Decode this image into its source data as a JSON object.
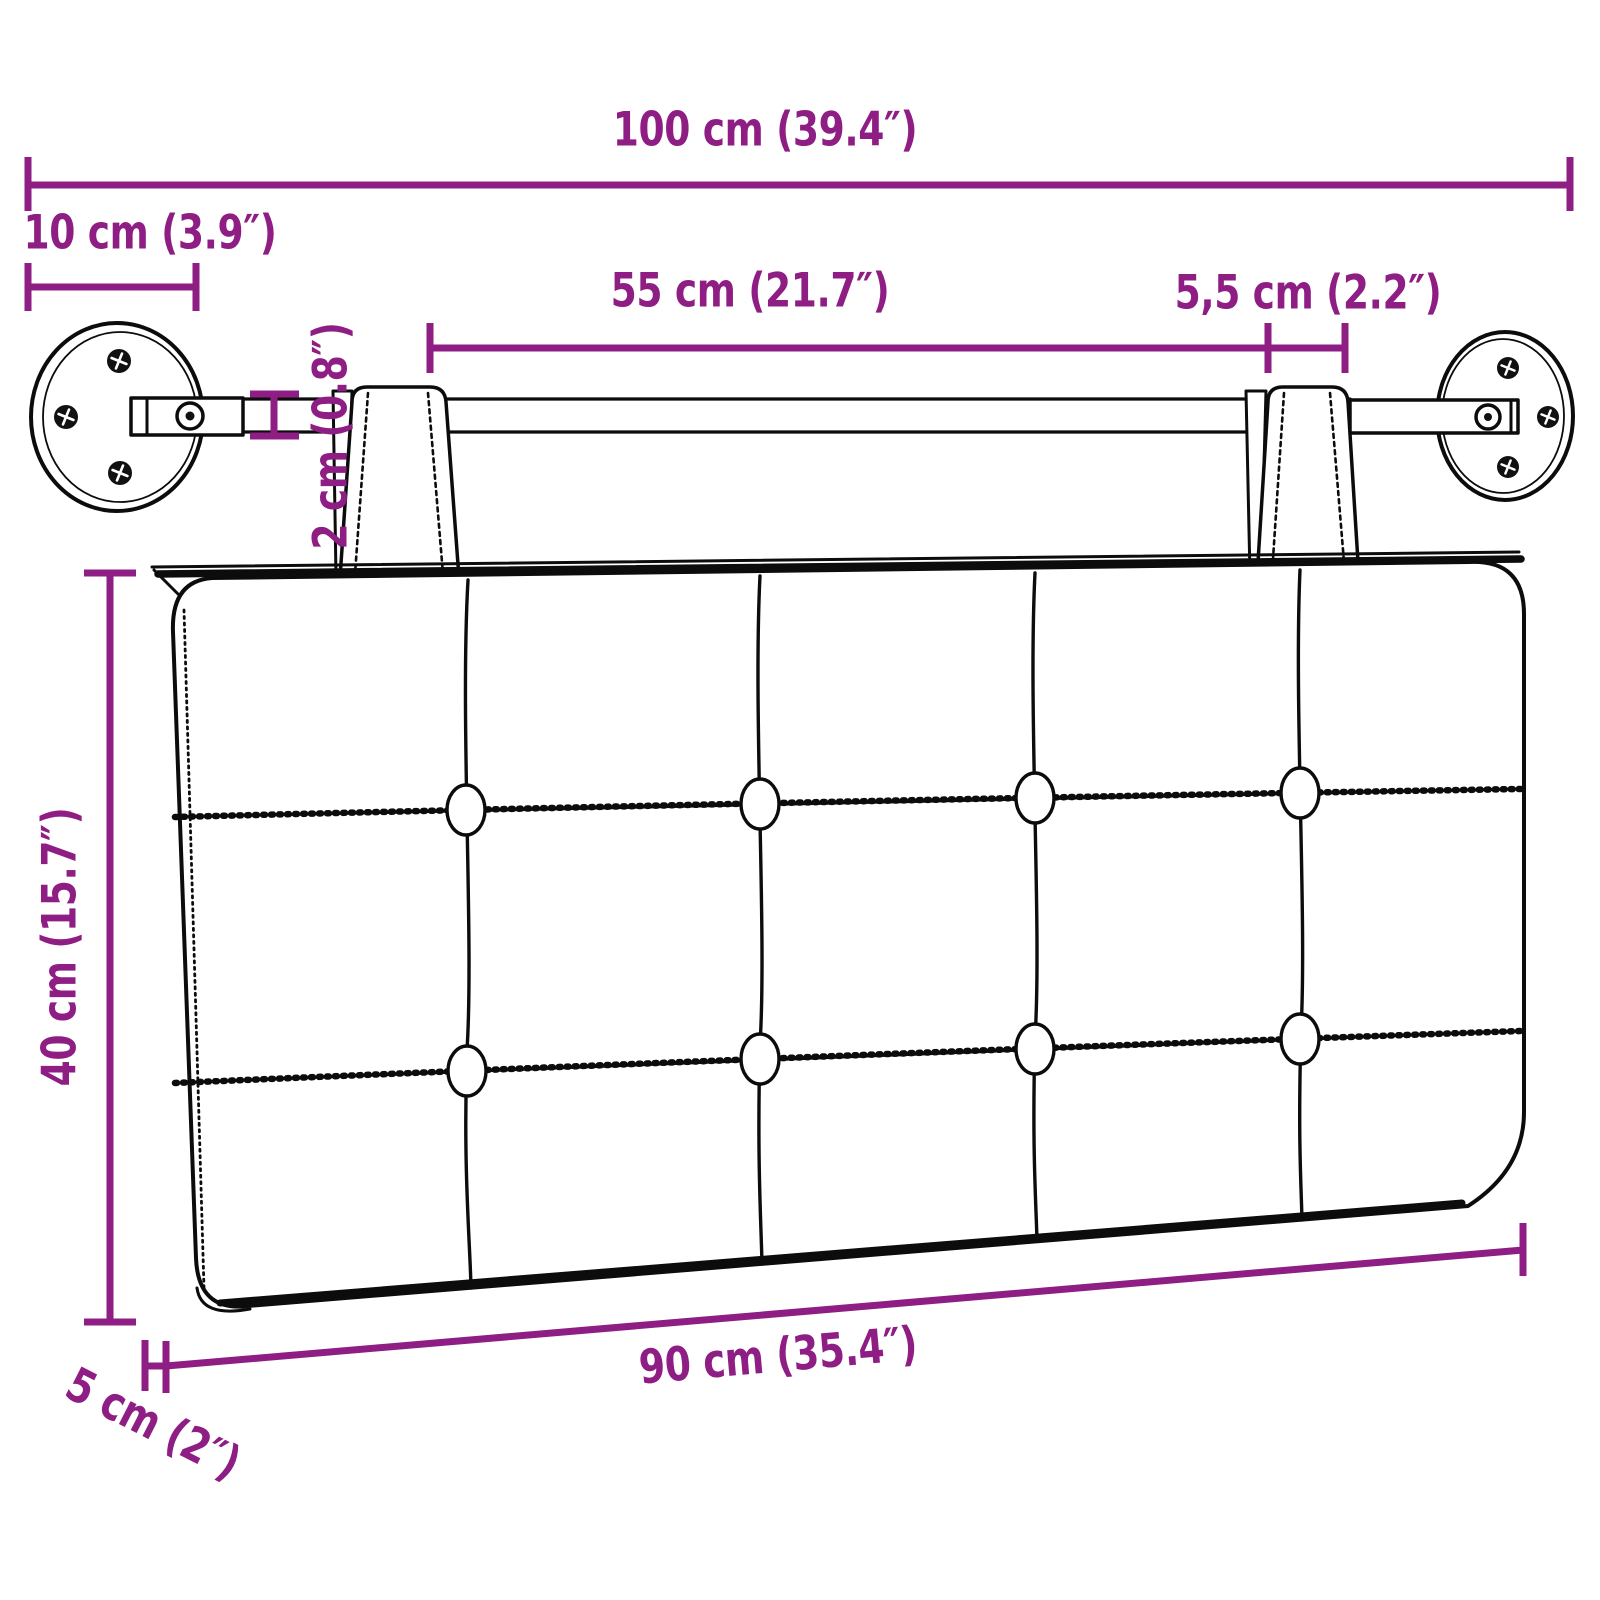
{
  "title": "Wall-mounted headboard cushion dimension diagram",
  "colors": {
    "dimension_accent": "#8E1E84",
    "line_art": "#0C0C0C",
    "background": "#FFFFFF"
  },
  "labels": {
    "total_width": "100 cm (39.4″)",
    "mount_offset": "10 cm (3.9″)",
    "strap_distance": "55 cm (21.7″)",
    "strap_width": "5,5 cm (2.2″)",
    "rod_thickness": "2 cm (0.8″)",
    "cushion_height": "40 cm (15.7″)",
    "cushion_width": "90 cm (35.4″)",
    "cushion_depth": "5 cm (2″)"
  },
  "measurements": [
    {
      "id": "total_width",
      "cm": "100",
      "inches": "39.4"
    },
    {
      "id": "mount_offset",
      "cm": "10",
      "inches": "3.9"
    },
    {
      "id": "strap_distance",
      "cm": "55",
      "inches": "21.7"
    },
    {
      "id": "strap_width",
      "cm": "5,5",
      "inches": "2.2"
    },
    {
      "id": "rod_thickness",
      "cm": "2",
      "inches": "0.8"
    },
    {
      "id": "cushion_height",
      "cm": "40",
      "inches": "15.7"
    },
    {
      "id": "cushion_width",
      "cm": "90",
      "inches": "35.4"
    },
    {
      "id": "cushion_depth",
      "cm": "5",
      "inches": "2"
    }
  ],
  "figure_parts": [
    "wall-mount-plate-left",
    "wall-mount-plate-right",
    "mounting-rod",
    "mounting-bracket-left",
    "mounting-bracket-right",
    "hanging-strap-left",
    "hanging-strap-right",
    "tufted-headboard-cushion",
    "tufting-buttons"
  ]
}
